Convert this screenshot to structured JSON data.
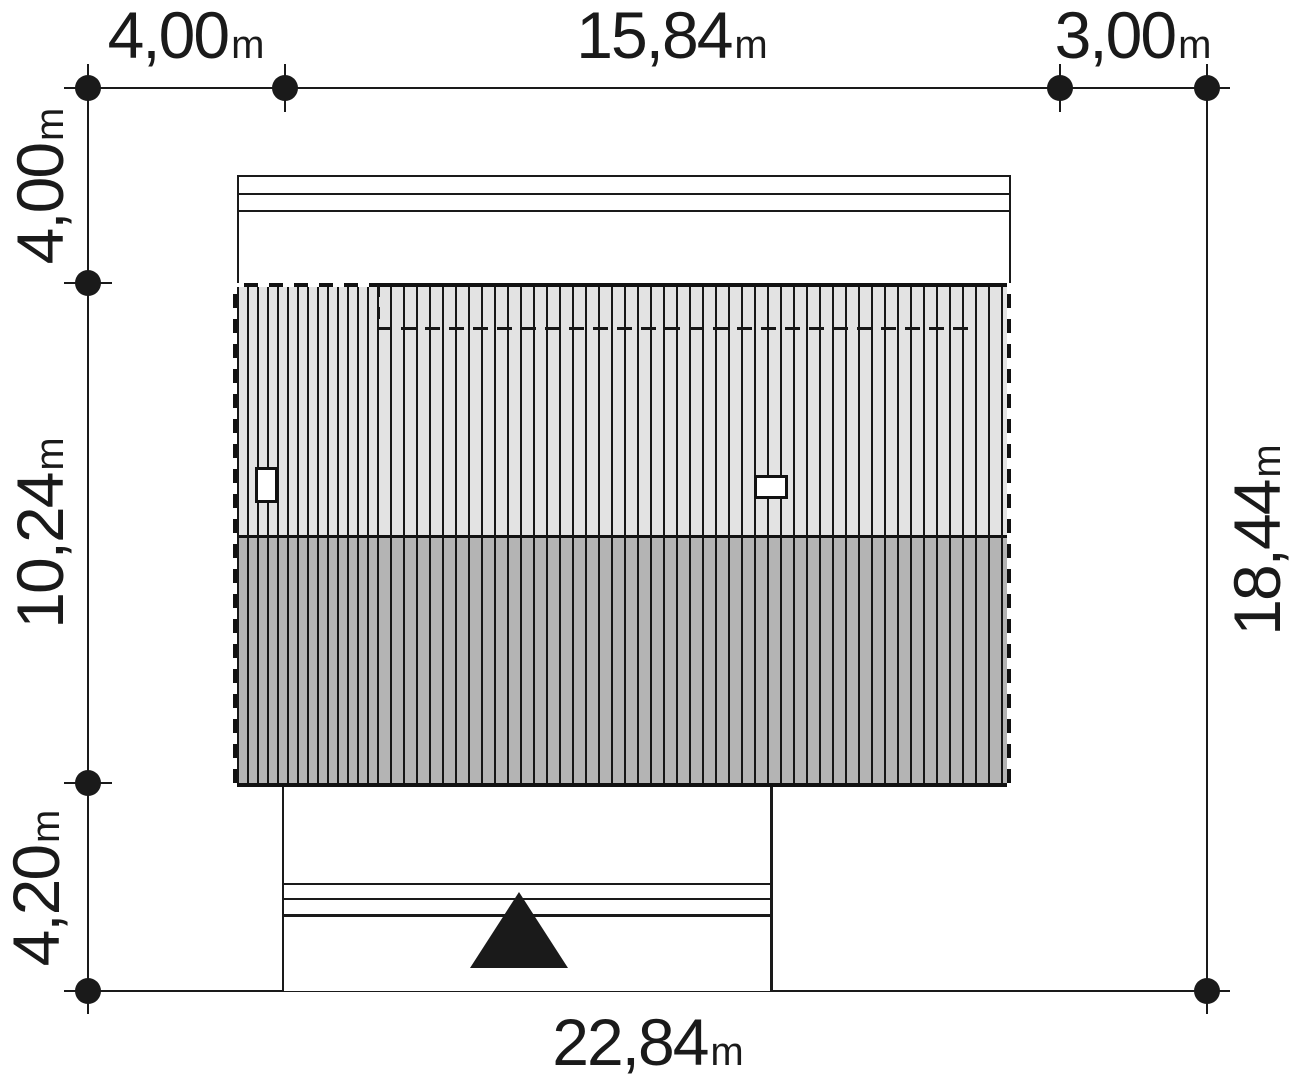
{
  "drawing": {
    "type": "architectural-site-plan",
    "units": "m"
  },
  "dimensions": {
    "top": [
      {
        "value": "4,00",
        "unit": "m"
      },
      {
        "value": "15,84",
        "unit": "m"
      },
      {
        "value": "3,00",
        "unit": "m"
      }
    ],
    "left": [
      {
        "value": "4,00",
        "unit": "m"
      },
      {
        "value": "10,24",
        "unit": "m"
      },
      {
        "value": "4,20",
        "unit": "m"
      }
    ],
    "right": [
      {
        "value": "18,44",
        "unit": "m"
      }
    ],
    "bottom": [
      {
        "value": "22,84",
        "unit": "m"
      }
    ]
  },
  "colors": {
    "line": "#1a1a1a",
    "roof_light": "#e3e3e3",
    "roof_dark": "#b4b4b4",
    "background": "#ffffff"
  }
}
